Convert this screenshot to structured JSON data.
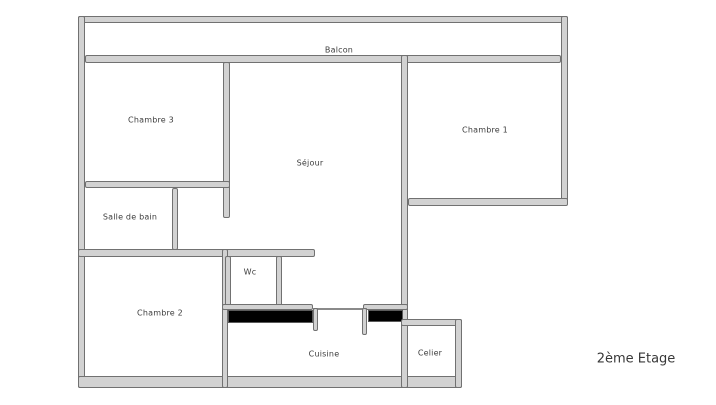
{
  "floorplan": {
    "title": "2ème Etage",
    "rooms": {
      "balcon": {
        "label": "Balcon"
      },
      "chambre3": {
        "label": "Chambre 3"
      },
      "sejour": {
        "label": "Séjour"
      },
      "chambre1": {
        "label": "Chambre 1"
      },
      "salle_de_bain": {
        "label": "Salle de bain"
      },
      "wc": {
        "label": "Wc"
      },
      "chambre2": {
        "label": "Chambre 2"
      },
      "cuisine": {
        "label": "Cuisine"
      },
      "celier": {
        "label": "Celier"
      }
    },
    "colors": {
      "background": "#ffffff",
      "wall_fill": "#d2d2d2",
      "wall_border": "#717171",
      "block_fill": "#000000",
      "text": "#3d3d3d"
    }
  }
}
